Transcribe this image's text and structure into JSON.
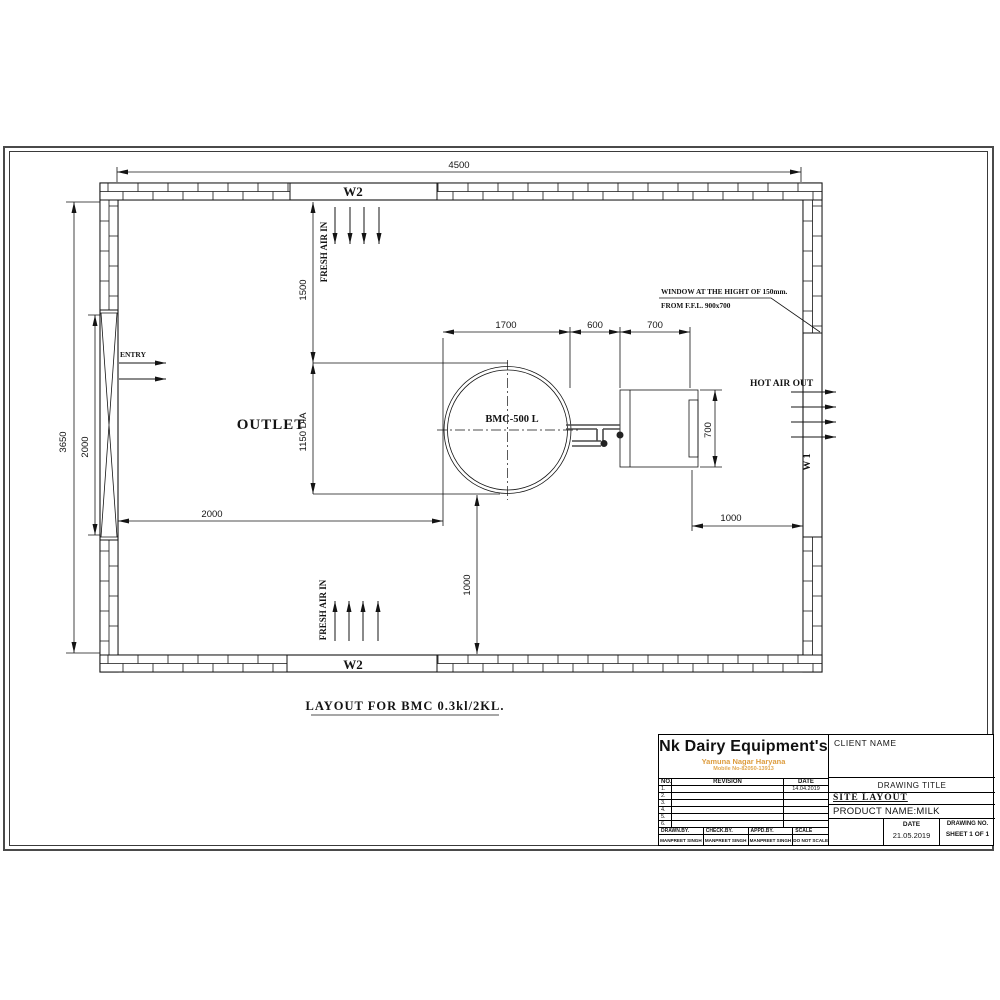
{
  "plan": {
    "caption": "LAYOUT FOR BMC 0.3kl/2KL.",
    "dims": {
      "overall_width": "4500",
      "overall_height": "3650",
      "entry_door": "2000",
      "front_clear": "1500",
      "tank_offset": "2000",
      "tank_dia": "1150 DIA",
      "tank_zone": "1700",
      "gap": "600",
      "condenser_w": "700",
      "condenser_h": "700",
      "bottom_clear": "1000",
      "right_clear": "1000"
    },
    "labels": {
      "w2": "W2",
      "w1": "W 1",
      "fresh_air": "FRESH AIR IN",
      "hot_air": "HOT AIR OUT",
      "entry": "ENTRY",
      "outlet": "OUTLET",
      "tank": "BMC-500 L",
      "note1": "WINDOW AT THE HIGHT OF 150mm.",
      "note2": "FROM F.F.L. 900x700"
    }
  },
  "titleblock": {
    "company": "Nk Dairy Equipment's",
    "address": "Yamuna Nagar Haryana",
    "mobile": "Mobile No-82050-13913",
    "client_label": "CLIENT NAME",
    "rev_table": {
      "no_label": "NO.",
      "revision_label": "REVISION",
      "date_label": "DATE",
      "rows": [
        {
          "no": "1.",
          "date": "14.04.2019"
        },
        {
          "no": "2.",
          "date": ""
        },
        {
          "no": "3.",
          "date": ""
        },
        {
          "no": "4.",
          "date": ""
        },
        {
          "no": "5.",
          "date": ""
        },
        {
          "no": "6.",
          "date": ""
        }
      ]
    },
    "drawing_title_label": "DRAWING TITLE",
    "drawing_title": "SITE LAYOUT",
    "product": "PRODUCT NAME:MILK",
    "date_label": "DATE",
    "date": "21.05.2019",
    "drawing_no_label": "DRAWING NO.",
    "sheet": "SHEET 1 OF 1",
    "sign": {
      "drawn_label": "DRAWN.BY.",
      "check_label": "CHECK.BY.",
      "appd_label": "APPD.BY.",
      "scale_label": "SCALE",
      "drawn": "MANPREET SINGH",
      "check": "MANPREET SINGH",
      "appd": "MANPREET SINGH",
      "scale": "DO NOT SCALE"
    }
  }
}
